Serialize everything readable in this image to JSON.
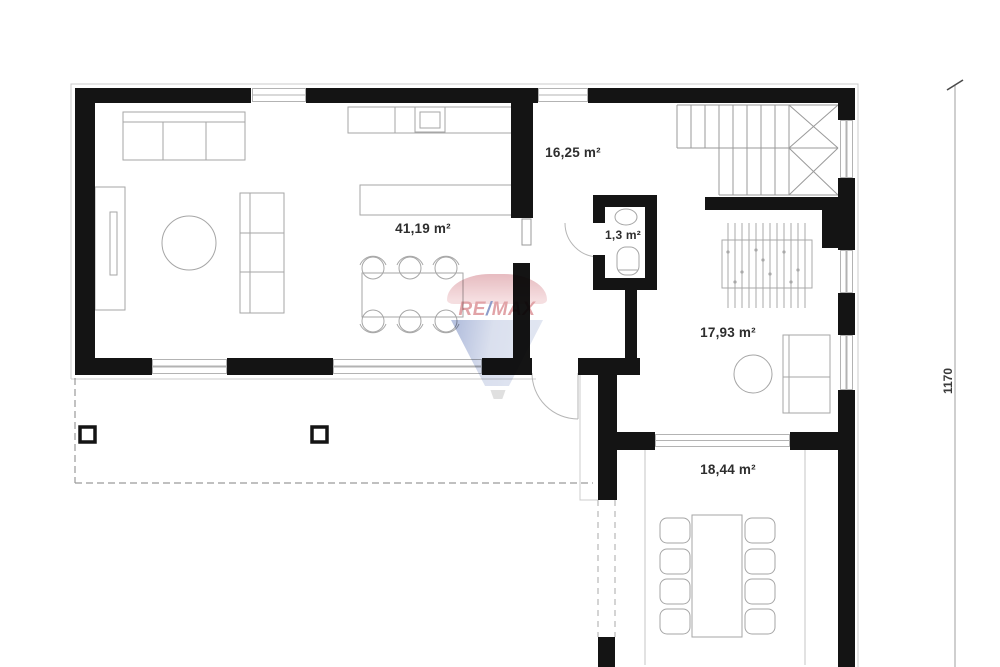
{
  "rooms": [
    {
      "id": "living-kitchen",
      "area_label": "41,19 m²"
    },
    {
      "id": "hallway",
      "area_label": "16,25 m²"
    },
    {
      "id": "wc",
      "area_label": "1,3 m²"
    },
    {
      "id": "room-right",
      "area_label": "17,93 m²"
    },
    {
      "id": "room-bottom",
      "area_label": "18,44 m²"
    }
  ],
  "dimensions": {
    "right_vertical": "1170"
  },
  "watermark": {
    "left": "RE",
    "slash": "/",
    "right": "MAX",
    "red": "#c9565e",
    "blue": "#2d4a9e"
  }
}
